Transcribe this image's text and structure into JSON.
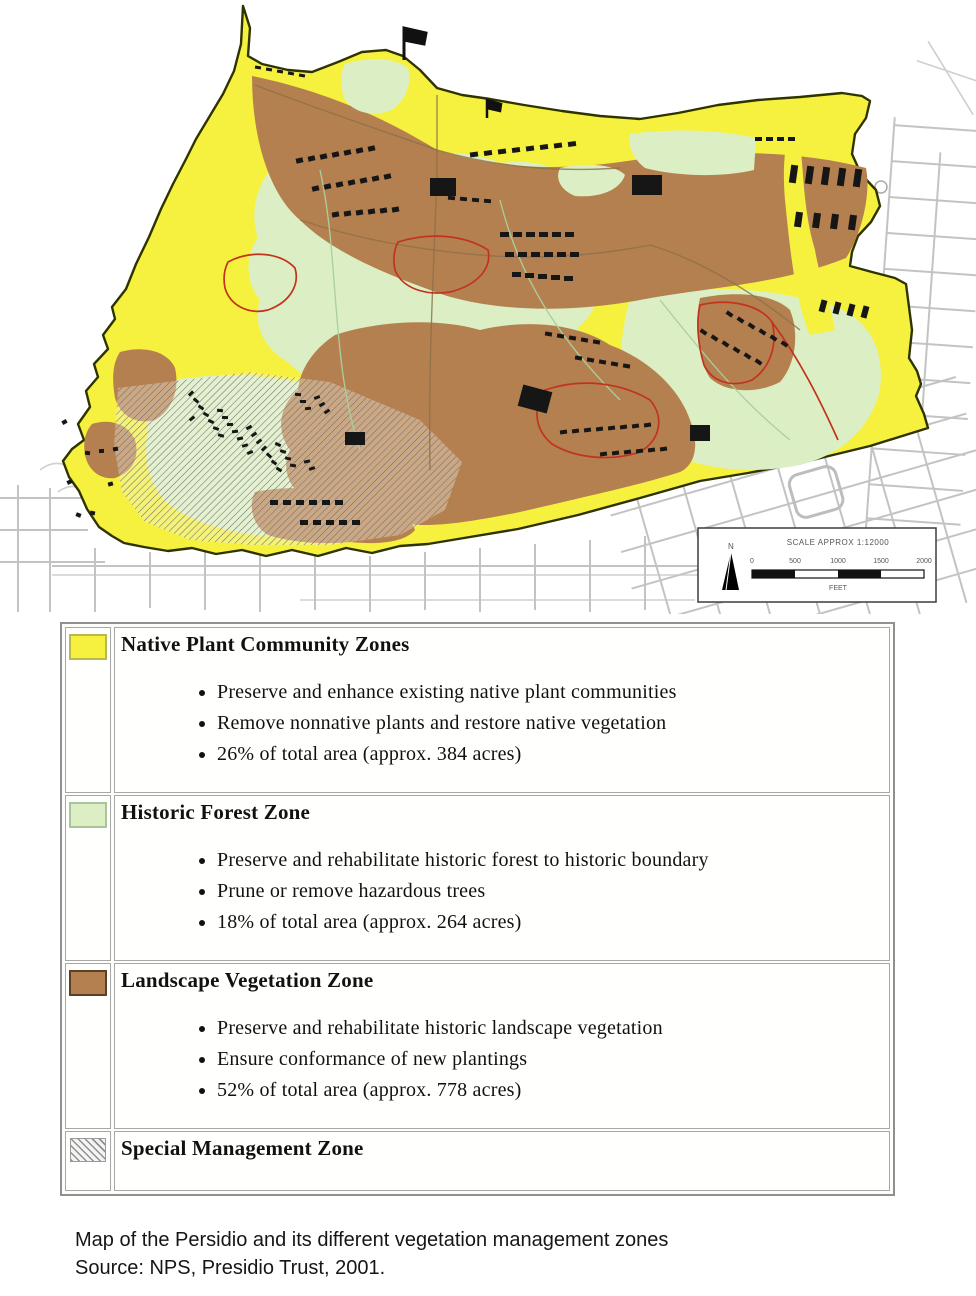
{
  "colors": {
    "yellow": "#F6F13E",
    "green": "#DCEFC4",
    "brown": "#B5804F",
    "red": "#C2331F",
    "boundary": "#2F3300"
  },
  "map": {
    "scale": {
      "title": "SCALE APPROX 1:12000",
      "ticks": [
        "0",
        "500",
        "1000",
        "1500",
        "2000"
      ],
      "unit": "FEET",
      "north_label": "N"
    }
  },
  "legend": {
    "rows": [
      {
        "title": "Native Plant Community Zones",
        "bullets": [
          "Preserve and enhance existing native plant communities",
          "Remove nonnative plants and restore native vegetation",
          "26% of total area (approx. 384 acres)"
        ]
      },
      {
        "title": "Historic Forest Zone",
        "bullets": [
          "Preserve and rehabilitate historic forest to historic boundary",
          "Prune or remove hazardous trees",
          "18% of total area (approx. 264 acres)"
        ]
      },
      {
        "title": "Landscape Vegetation Zone",
        "bullets": [
          "Preserve and rehabilitate historic landscape vegetation",
          "Ensure conformance of new plantings",
          "52% of total area (approx. 778 acres)"
        ]
      },
      {
        "title": "Special Management Zone",
        "bullets": []
      }
    ]
  },
  "caption": {
    "line1": "Map of the Persidio and its different vegetation management zones",
    "line2": "Source: NPS, Presidio Trust, 2001."
  }
}
